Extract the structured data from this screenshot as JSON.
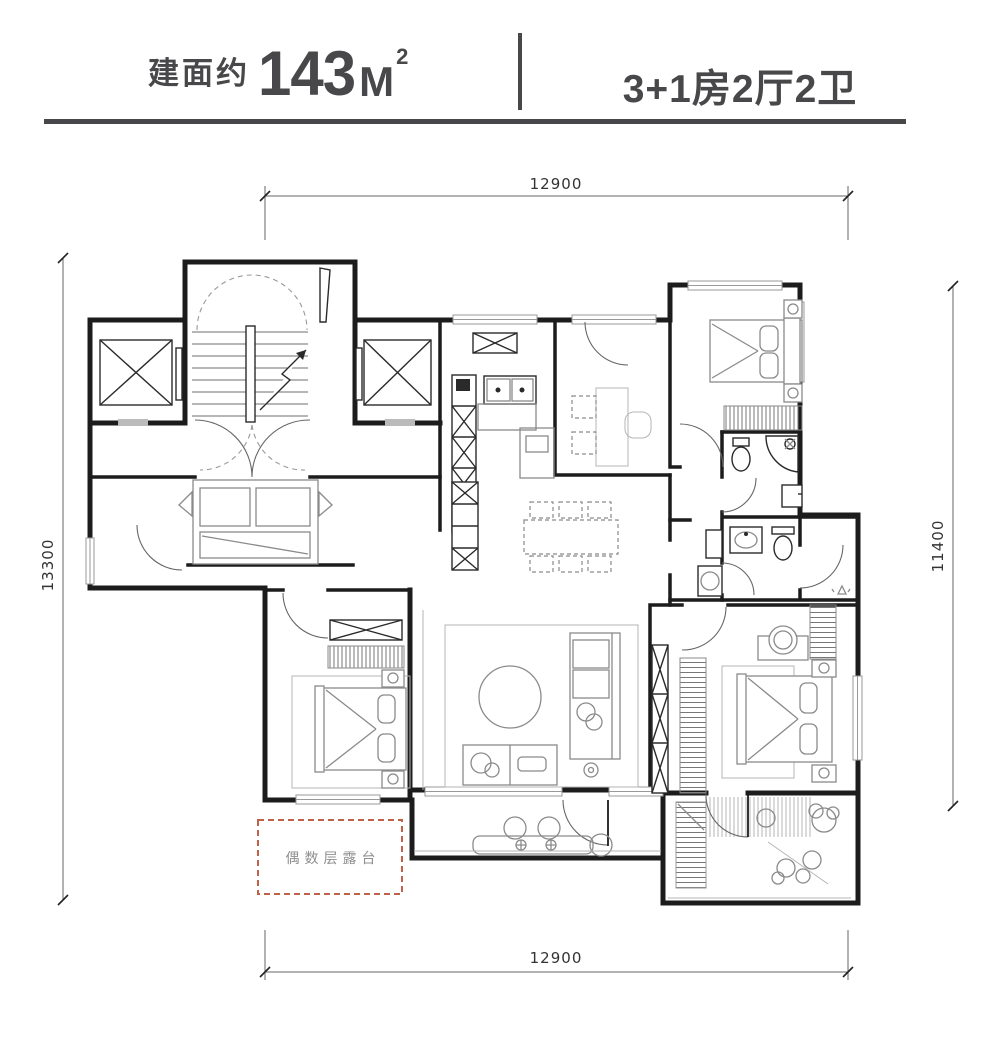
{
  "header": {
    "area_prefix": "建面约",
    "area_value": "143",
    "area_unit": "M",
    "area_exponent": "2",
    "layout_spec": "3+1房2厅2卫"
  },
  "dimensions": {
    "top": "12900",
    "bottom": "12900",
    "left": "13300",
    "right": "11400"
  },
  "annotations": {
    "terrace_label": "偶数层露台"
  },
  "colors": {
    "header_text": "#48484a",
    "wall": "#1c1c1c",
    "furniture": "#8a8a8a",
    "dim": "#666666",
    "terrace": "#c0614a"
  }
}
